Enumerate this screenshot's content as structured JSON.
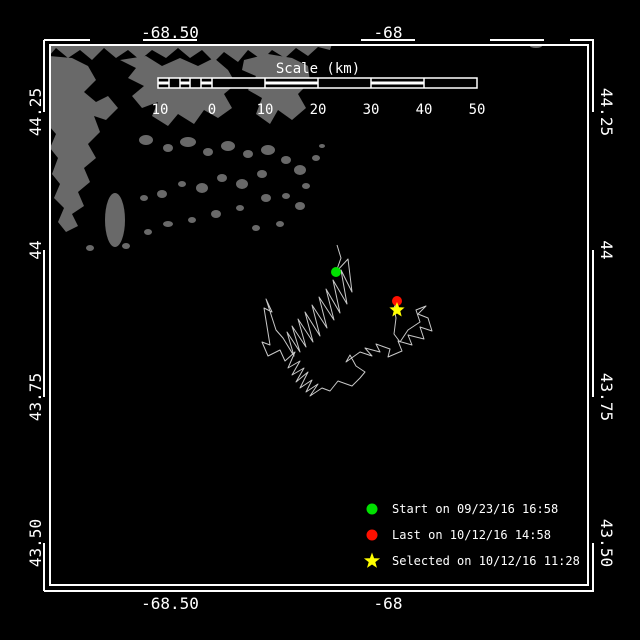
{
  "window": {
    "width": 640,
    "height": 640,
    "background": "#000000"
  },
  "map": {
    "frame_color": "#ffffff",
    "land_color": "#696969",
    "water_color": "#000000"
  },
  "axes": {
    "top": [
      {
        "label": "-68.50"
      },
      {
        "label": "-68"
      }
    ],
    "bottom": [
      {
        "label": "-68.50"
      },
      {
        "label": "-68"
      }
    ],
    "left": [
      {
        "label": "44.25"
      },
      {
        "label": "44"
      },
      {
        "label": "43.75"
      },
      {
        "label": "43.50"
      }
    ],
    "right": [
      {
        "label": "44.25"
      },
      {
        "label": "44"
      },
      {
        "label": "43.75"
      },
      {
        "label": "43.50"
      }
    ]
  },
  "scale_bar": {
    "title": "Scale (km)",
    "tick_labels": [
      "10",
      "0",
      "10",
      "20",
      "30",
      "40",
      "50"
    ]
  },
  "legend": {
    "items": [
      {
        "marker": "circle",
        "color": "#00e000",
        "label": "Start on 09/23/16 16:58"
      },
      {
        "marker": "circle",
        "color": "#ff1000",
        "label": "Last on 10/12/16 14:58"
      },
      {
        "marker": "star",
        "color": "#ffff00",
        "label": "Selected on 10/12/16 11:28"
      }
    ]
  },
  "chart_data": {
    "type": "line",
    "title": "Animal/vessel GPS track over coastal chart",
    "x_axis": {
      "label": "longitude (deg)",
      "ticks": [
        -68.5,
        -68
      ]
    },
    "y_axis": {
      "label": "latitude (deg)",
      "ticks": [
        44.25,
        44.0,
        43.75,
        43.5
      ]
    },
    "legend_position": "bottom-right",
    "grid": false,
    "track_color": "#c8c8c8",
    "track_px": [
      [
        337,
        245
      ],
      [
        341,
        258
      ],
      [
        336,
        272
      ],
      [
        348,
        259
      ],
      [
        352,
        292
      ],
      [
        341,
        270
      ],
      [
        347,
        304
      ],
      [
        333,
        280
      ],
      [
        340,
        313
      ],
      [
        326,
        289
      ],
      [
        334,
        320
      ],
      [
        319,
        297
      ],
      [
        327,
        328
      ],
      [
        312,
        305
      ],
      [
        320,
        336
      ],
      [
        305,
        312
      ],
      [
        313,
        342
      ],
      [
        298,
        319
      ],
      [
        306,
        347
      ],
      [
        292,
        326
      ],
      [
        300,
        352
      ],
      [
        287,
        332
      ],
      [
        294,
        356
      ],
      [
        283,
        338
      ],
      [
        276,
        330
      ],
      [
        266,
        299
      ],
      [
        272,
        312
      ],
      [
        264,
        308
      ],
      [
        270,
        345
      ],
      [
        262,
        342
      ],
      [
        268,
        356
      ],
      [
        280,
        350
      ],
      [
        285,
        361
      ],
      [
        295,
        352
      ],
      [
        288,
        368
      ],
      [
        300,
        361
      ],
      [
        292,
        375
      ],
      [
        304,
        368
      ],
      [
        296,
        382
      ],
      [
        308,
        372
      ],
      [
        300,
        388
      ],
      [
        312,
        380
      ],
      [
        306,
        392
      ],
      [
        318,
        384
      ],
      [
        310,
        396
      ],
      [
        322,
        388
      ],
      [
        330,
        391
      ],
      [
        338,
        381
      ],
      [
        352,
        386
      ],
      [
        360,
        378
      ],
      [
        365,
        372
      ],
      [
        356,
        366
      ],
      [
        350,
        355
      ],
      [
        346,
        362
      ],
      [
        360,
        352
      ],
      [
        372,
        356
      ],
      [
        365,
        348
      ],
      [
        380,
        352
      ],
      [
        376,
        344
      ],
      [
        390,
        349
      ],
      [
        388,
        357
      ],
      [
        402,
        351
      ],
      [
        398,
        341
      ],
      [
        412,
        345
      ],
      [
        408,
        335
      ],
      [
        424,
        339
      ],
      [
        420,
        327
      ],
      [
        432,
        331
      ],
      [
        428,
        318
      ],
      [
        418,
        314
      ],
      [
        426,
        306
      ],
      [
        416,
        310
      ],
      [
        420,
        322
      ],
      [
        408,
        330
      ],
      [
        400,
        342
      ],
      [
        394,
        334
      ],
      [
        396,
        318
      ],
      [
        394,
        308
      ],
      [
        397,
        301
      ]
    ],
    "markers": [
      {
        "name": "start",
        "shape": "circle",
        "color": "#00e000",
        "x": 336,
        "y": 272
      },
      {
        "name": "last",
        "shape": "circle",
        "color": "#ff1000",
        "x": 397,
        "y": 301
      },
      {
        "name": "selected",
        "shape": "star",
        "color": "#ffff00",
        "x": 397,
        "y": 310
      }
    ]
  }
}
